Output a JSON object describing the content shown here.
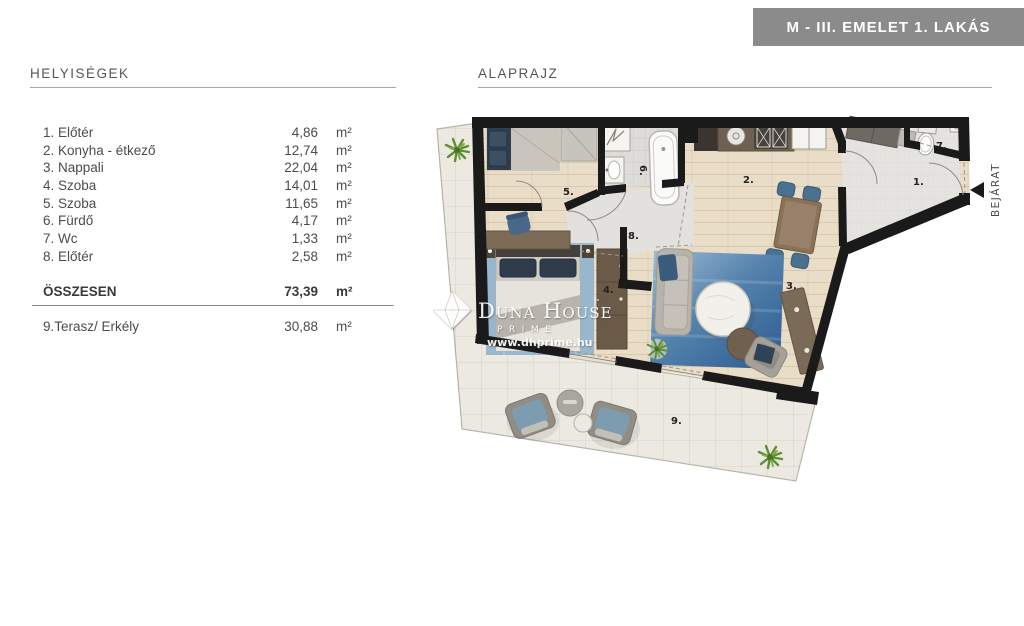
{
  "banner": {
    "title": "M - III. EMELET 1. LAKÁS",
    "bg": "#8b8b8b"
  },
  "rooms_panel": {
    "header": "HELYISÉGEK",
    "rows": [
      {
        "name": "1. Előtér",
        "value": "4,86",
        "unit": "m²"
      },
      {
        "name": "2. Konyha - étkező",
        "value": "12,74",
        "unit": "m²"
      },
      {
        "name": "3. Nappali",
        "value": "22,04",
        "unit": "m²"
      },
      {
        "name": "4. Szoba",
        "value": "14,01",
        "unit": "m²"
      },
      {
        "name": "5. Szoba",
        "value": "11,65",
        "unit": "m²"
      },
      {
        "name": "6. Fürdő",
        "value": "4,17",
        "unit": "m²"
      },
      {
        "name": "7. Wc",
        "value": "1,33",
        "unit": "m²"
      },
      {
        "name": "8. Előtér",
        "value": "2,58",
        "unit": "m²"
      }
    ],
    "total": {
      "label": "ÖSSZESEN",
      "value": "73,39",
      "unit": "m²"
    },
    "terrace": {
      "name": "9.Terasz/ Erkély",
      "value": "30,88",
      "unit": "m²"
    }
  },
  "plan": {
    "header": "ALAPRAJZ",
    "labels": [
      "1.",
      "2.",
      "3.",
      "4.",
      "5.",
      "6.",
      "7.",
      "8.",
      "9."
    ],
    "entrance": "BEJÁRAT",
    "watermark": {
      "brand": "Duna House",
      "tm": "™",
      "sub": "PRIME",
      "url": "www.dhprime.hu"
    }
  },
  "colors": {
    "banner_bg": "#8b8b8b",
    "wall": "#1a1a1a",
    "wood_floor": "#e9ddc7",
    "tile_floor": "#dddcd8",
    "hall_floor": "#e4e3df",
    "terrace_floor": "#ebe9e0",
    "rug_blue": "#3f6d9e",
    "furniture_brown": "#6b5a48",
    "chair_blue": "#4a7190"
  }
}
